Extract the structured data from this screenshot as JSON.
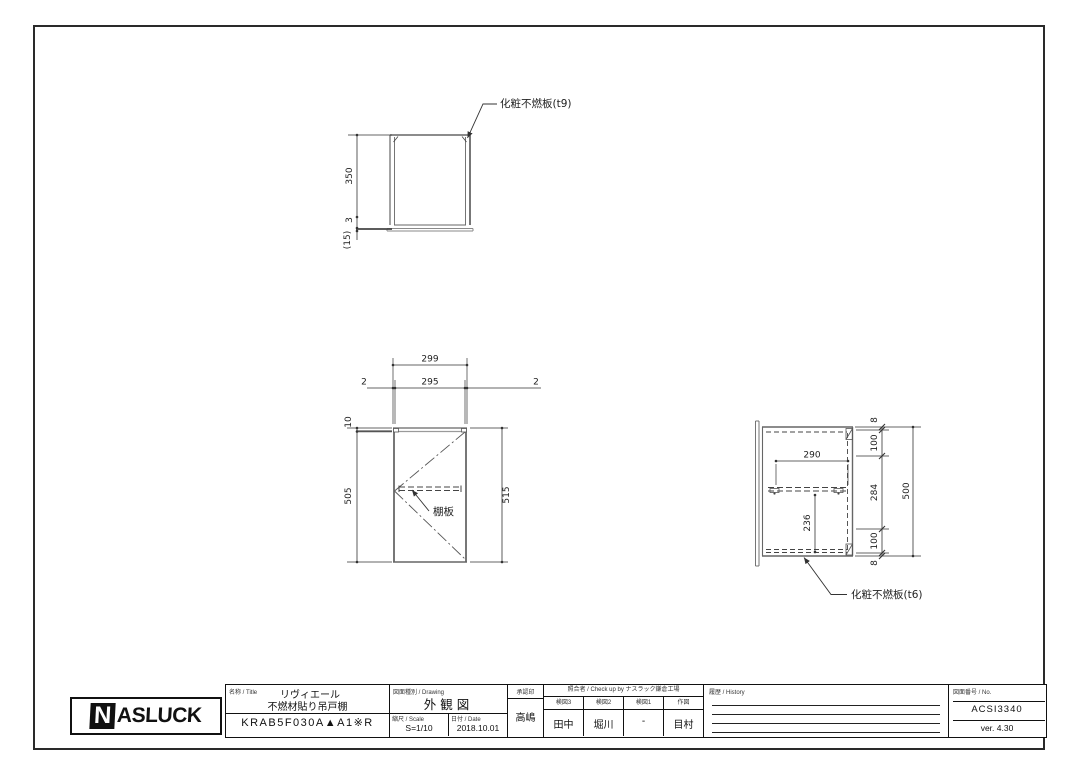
{
  "views": {
    "top": {
      "callout": "化粧不燃板(t9)",
      "dim_350": "350",
      "dim_3": "3",
      "dim_15": "(15)"
    },
    "front": {
      "shelf_callout": "棚板",
      "dim_299": "299",
      "dim_295": "295",
      "dim_2_left": "2",
      "dim_2_right": "2",
      "dim_10": "10",
      "dim_505": "505",
      "dim_515": "515"
    },
    "side": {
      "callout": "化粧不燃板(t6)",
      "dim_290": "290",
      "dim_236": "236",
      "chain": [
        "8",
        "100",
        "284",
        "100",
        "8"
      ],
      "dim_500": "500"
    }
  },
  "title_block": {
    "logo_n": "N",
    "logo_rest": "ASLUCK",
    "name_label": "名称 / Title",
    "name_line1": "リヴィエール",
    "name_line2": "不燃材貼り吊戸棚",
    "model": "KRAB5F030A▲A1※R",
    "drawing_label": "図面種別 / Drawing",
    "drawing_value": "外観図",
    "scale_label": "縮尺 / Scale",
    "scale_value": "S=1/10",
    "date_label": "日付 / Date",
    "date_value": "2018.10.01",
    "stamp_label": "承認印",
    "stamp_value": "高嶋",
    "check_header": "照合者 / Check up by ナスラック鎌倉工場",
    "check_cols": [
      {
        "label": "検図3",
        "value": "田中"
      },
      {
        "label": "検図2",
        "value": "堀川"
      },
      {
        "label": "検図1",
        "value": "-"
      },
      {
        "label": "作図",
        "value": "目村"
      }
    ],
    "history_label": "履歴 / History",
    "no_label": "図面番号 / No.",
    "no_value": "ACSI3340",
    "version": "ver. 4.30"
  }
}
